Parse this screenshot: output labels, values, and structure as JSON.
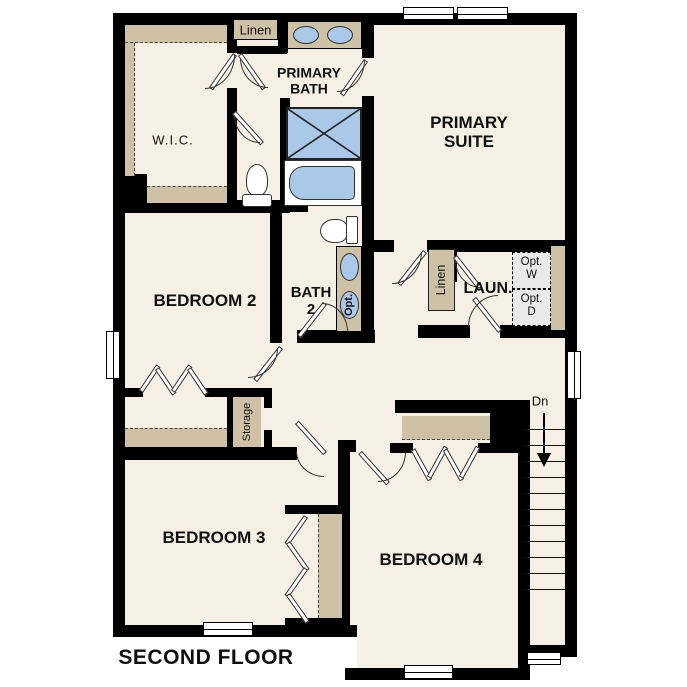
{
  "title": "SECOND FLOOR",
  "colors": {
    "wall": "#000000",
    "floor": "#f6efe3",
    "tan": "#cfc1a5",
    "blue": "#aac9e8",
    "gray": "#e9e9e9"
  },
  "rooms": {
    "wic": "W.I.C.",
    "linen_top": "Linen",
    "primary_bath": "PRIMARY\nBATH",
    "primary_suite": "PRIMARY\nSUITE",
    "bedroom2": "BEDROOM 2",
    "bath2": "BATH\n2",
    "opt_sink": "Opt.",
    "laundry": "LAUN.",
    "linen_laundry": "Linen",
    "opt_washer": "Opt.\nW",
    "opt_dryer": "Opt.\nD",
    "storage": "Storage",
    "bedroom3": "BEDROOM 3",
    "bedroom4": "BEDROOM 4",
    "stairs_down": "Dn"
  },
  "stairs": {
    "step_count": 11,
    "step_spacing_px": 16
  }
}
